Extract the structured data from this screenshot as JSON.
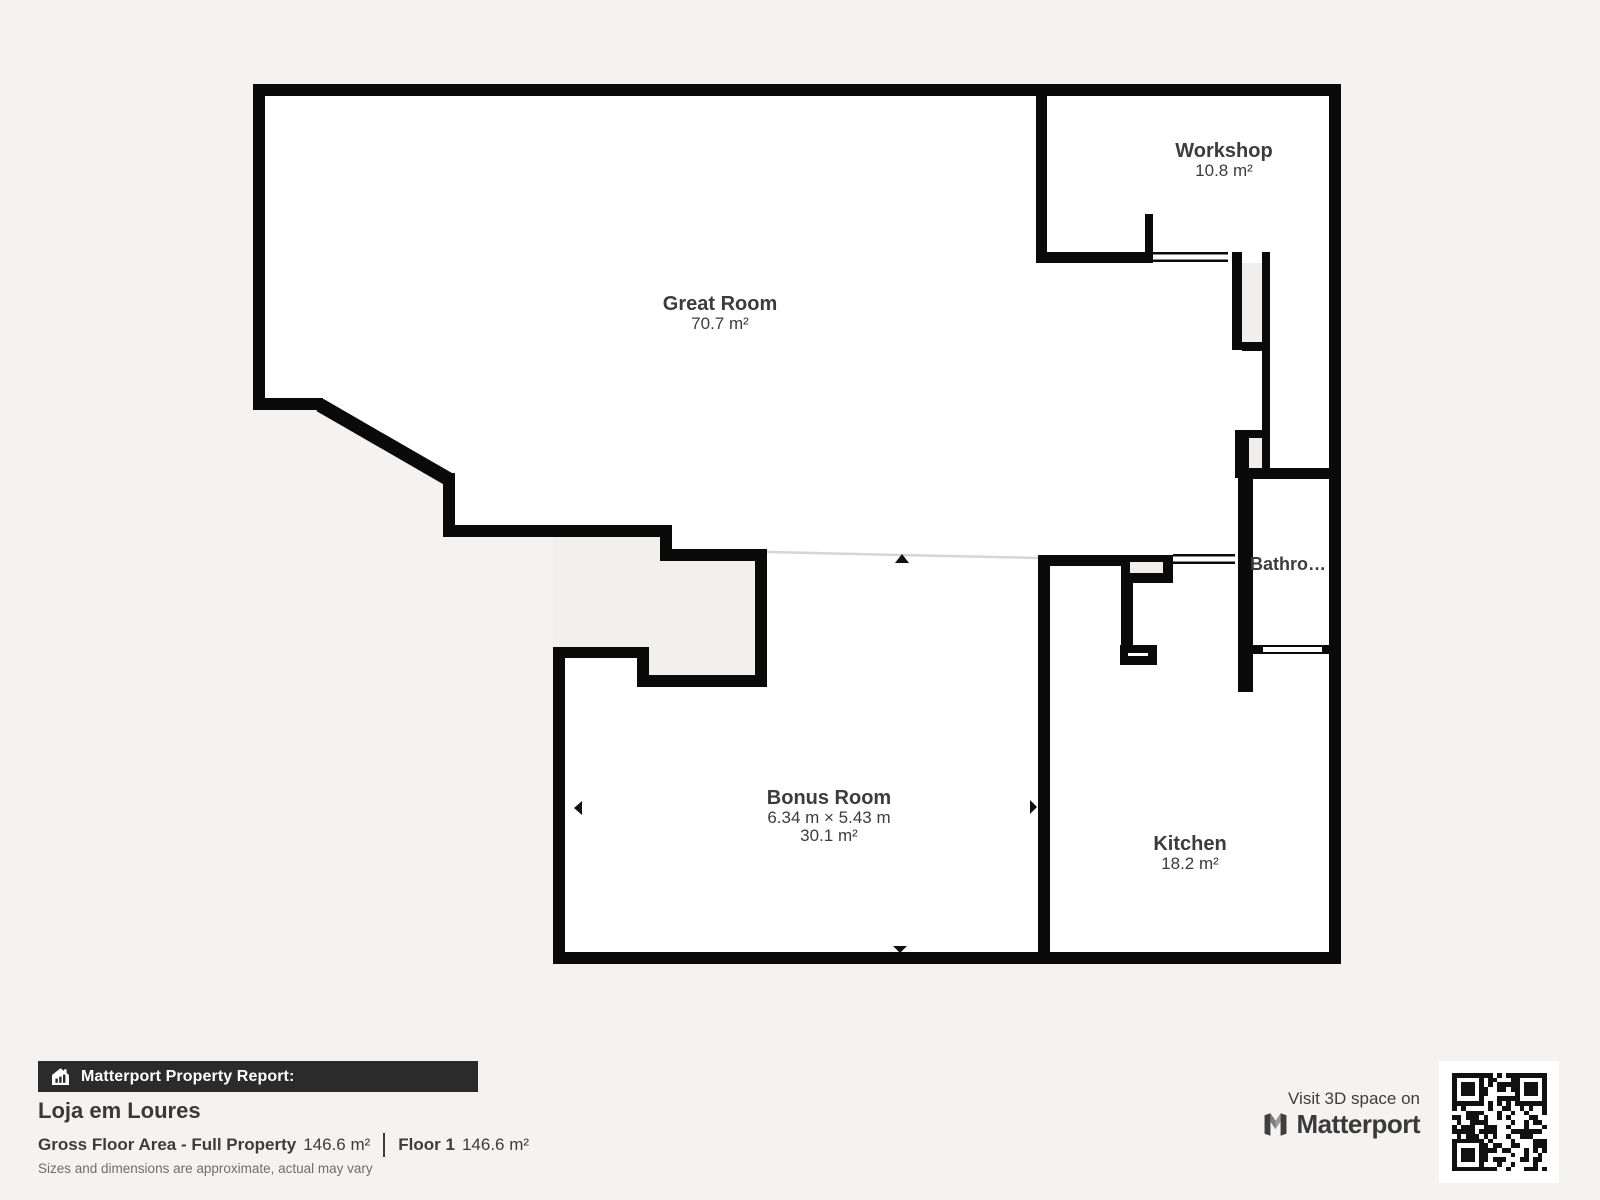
{
  "plan": {
    "wall_color": "#0a0a0a",
    "background_color": "#f4f3f1",
    "shaft_color": "#f0eeec",
    "open_line_color": "#d8d5d2",
    "rooms": [
      {
        "name": "Great Room",
        "area": "70.7 m²"
      },
      {
        "name": "Workshop",
        "area": "10.8 m²"
      },
      {
        "name": "Bathro…",
        "area": ""
      },
      {
        "name": "Bonus Room",
        "dimensions": "6.34 m × 5.43 m",
        "area": "30.1 m²"
      },
      {
        "name": "Kitchen",
        "area": "18.2 m²"
      }
    ]
  },
  "footer": {
    "report_label": "Matterport Property Report:",
    "property_name": "Loja em Loures",
    "gross_label": "Gross Floor Area - Full Property",
    "gross_value": "146.6 m²",
    "floor_label": "Floor 1",
    "floor_value": "146.6 m²",
    "disclaimer": "Sizes and dimensions are approximate, actual may vary"
  },
  "cta": {
    "visit_text": "Visit 3D space on",
    "brand": "Matterport"
  }
}
